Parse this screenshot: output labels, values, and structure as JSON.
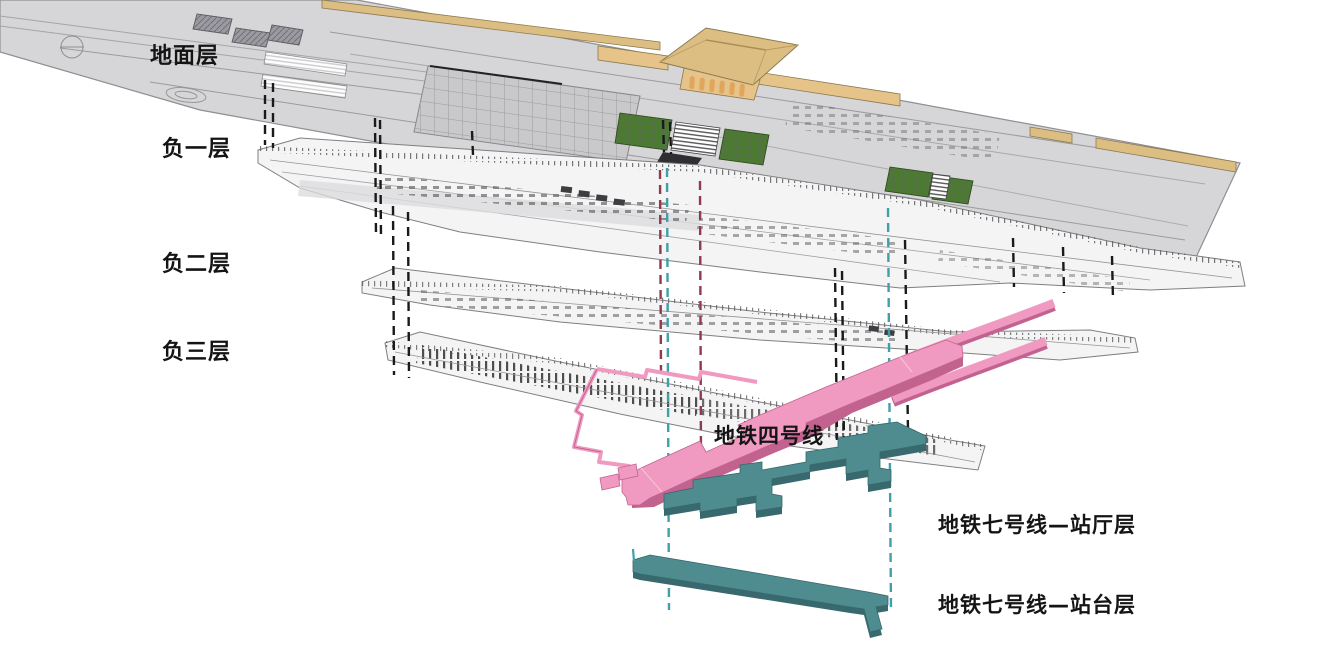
{
  "diagram": {
    "type": "exploded-axonometric-section",
    "subject": "railway-station-multi-level-structure",
    "levels": [
      {
        "id": "ground",
        "label": "地面层"
      },
      {
        "id": "b1",
        "label": "负一层"
      },
      {
        "id": "b2",
        "label": "负二层"
      },
      {
        "id": "b3",
        "label": "负三层"
      },
      {
        "id": "line4",
        "label": "地铁四号线"
      },
      {
        "id": "line7_concourse",
        "label": "地铁七号线—站厅层"
      },
      {
        "id": "line7_platform",
        "label": "地铁七号线—站台层"
      }
    ],
    "colors": {
      "line4_pink": "#F09AC2",
      "line4_pink_dark": "#C2638F",
      "line7_teal": "#4E8C8F",
      "line7_teal_dark": "#38696E",
      "ground_gray": "#D6D6D8",
      "plan_light": "#F4F4F4",
      "roof_tan": "#DCBE83",
      "wall_tan": "#E6C489",
      "arch_orange": "#E2A55C",
      "landscape_green": "#4C7A33",
      "ref_black": "#1A1A1A",
      "ref_maroon": "#8E3A52",
      "ref_teal": "#3FA0AA"
    }
  }
}
